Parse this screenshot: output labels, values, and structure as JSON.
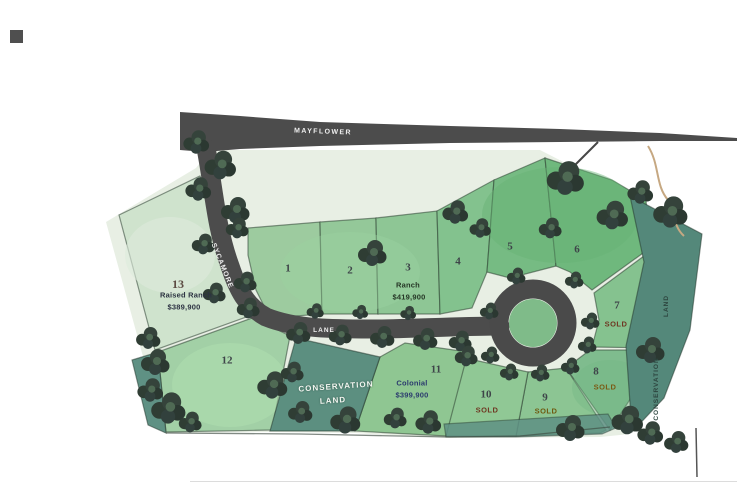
{
  "roads": {
    "mayflower": "MAYFLOWER",
    "sycamore": "SYCAMORE",
    "lane": "LANE"
  },
  "conservation": {
    "overlay_line1": "CONSERVATION",
    "overlay_line2": "LAND",
    "right_strip_line1": "CONSERVATION",
    "right_strip_line2": "LAND"
  },
  "lots": {
    "lot1": "1",
    "lot2": "2",
    "lot3": "3",
    "lot4": "4",
    "lot5": "5",
    "lot6": "6",
    "lot7": "7",
    "lot8": "8",
    "lot9": "9",
    "lot10": "10",
    "lot11": "11",
    "lot12": "12",
    "lot13": "13"
  },
  "listings": {
    "lot13": {
      "type": "Raised Ranch",
      "price": "$389,900"
    },
    "lot3": {
      "type": "Ranch",
      "price": "$419,900"
    },
    "lot11": {
      "type": "Colonial",
      "price": "$399,900"
    }
  },
  "status": {
    "sold": "SOLD"
  },
  "colors": {
    "road": "#4c4c4c",
    "map_green": "#8cc88f",
    "conservation_teal": "#55917f",
    "sold_red": "#6f3722",
    "sold_olive": "#6f5a10"
  }
}
